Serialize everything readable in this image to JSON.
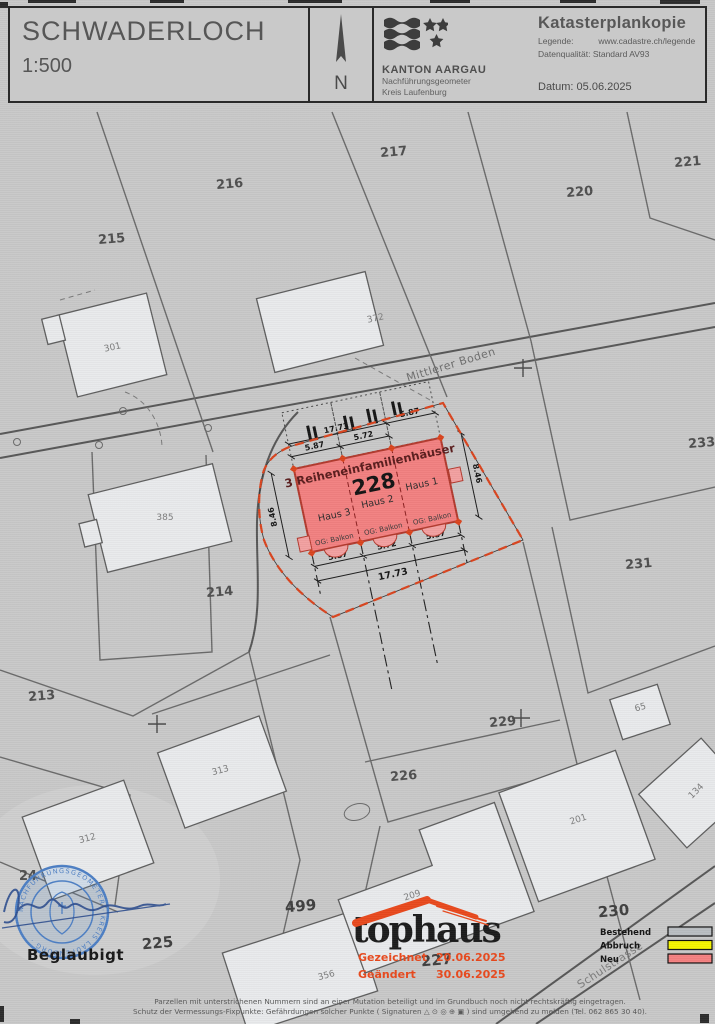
{
  "header": {
    "title": "SCHWADERLOCH",
    "scale": "1:500",
    "north_label": "N",
    "canton": "KANTON AARGAU",
    "office_line1": "Nachführungsgeometer",
    "office_line2": "Kreis Laufenburg",
    "doc_title": "Katasterplankopie",
    "legend_label": "Legende:",
    "legend_value": "www.cadastre.ch/legende",
    "quality": "Datenqualität: Standard AV93",
    "date_label": "Datum:",
    "date_value": "05.06.2025"
  },
  "map": {
    "streets": [
      {
        "label": "Mittlerer Boden"
      },
      {
        "label": "Schulstrasse"
      }
    ],
    "parcels": [
      {
        "label": "215"
      },
      {
        "label": "216"
      },
      {
        "label": "217"
      },
      {
        "label": "220"
      },
      {
        "label": "221"
      },
      {
        "label": "233"
      },
      {
        "label": "231"
      },
      {
        "label": "214"
      },
      {
        "label": "213"
      },
      {
        "label": "229"
      },
      {
        "label": "226"
      },
      {
        "label": "230"
      },
      {
        "label": "227"
      },
      {
        "label": "225"
      },
      {
        "label": "499"
      },
      {
        "label": "24"
      }
    ],
    "buildings": [
      {
        "label": "301"
      },
      {
        "label": "372"
      },
      {
        "label": "385"
      },
      {
        "label": "313"
      },
      {
        "label": "312"
      },
      {
        "label": "356"
      },
      {
        "label": "65"
      },
      {
        "label": "134"
      },
      {
        "label": "201"
      },
      {
        "label": "209"
      }
    ],
    "site": {
      "annotation": "3 Reiheneinfamilienhäuser",
      "parcel_number": "228",
      "houses": [
        "Haus 1",
        "Haus 2",
        "Haus 3"
      ],
      "balcony_label": "OG: Balkon",
      "dims": {
        "total": "17.73",
        "seg_end": "5.87",
        "seg_mid": "5.72",
        "depth": "8.46"
      }
    }
  },
  "footer": {
    "certified": "Beglaubigt",
    "logo_text": "tophaus",
    "drawn_label": "Gezeichnet",
    "drawn_date": "20.06.2025",
    "changed_label": "Geändert",
    "changed_date": "30.06.2025",
    "legend": [
      {
        "label": "Bestehend",
        "color": "#b9bdc1"
      },
      {
        "label": "Abbruch",
        "color": "#f6f600"
      },
      {
        "label": "Neu",
        "color": "#f58181"
      }
    ],
    "stamp_text": "NACHFÜHRUNGSGEOMETER · KREIS LAUFENBURG ·",
    "note_line1": "Parzellen mit unterstrichenen Nummern sind an einer Mutation beteiligt und im Grundbuch noch nicht rechtskräftig eingetragen.",
    "note_line2": "Schutz der Vermessungs-Fixpunkte: Gefährdungen solcher Punkte ( Signaturen △ ⊙ ◎ ⊕ ▣ ) sind umgehend zu melden (Tel. 062 865 30 40)."
  },
  "colors": {
    "site_new": "#f28080",
    "site_border": "#b23a2e",
    "boundary_orange": "#d9441e",
    "logo_accent": "#e8491d",
    "stamp_blue": "#4d7fc4"
  }
}
